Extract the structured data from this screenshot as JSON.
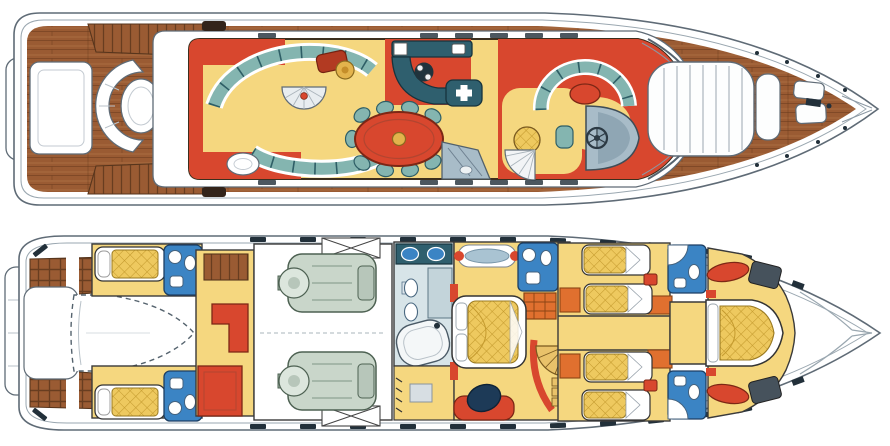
{
  "figure": {
    "label": "Motor yacht general arrangement drawing with two deck plans",
    "views": {
      "upper": {
        "label": "Main deck plan: aft cockpit with curved bench and table, saloon with curved sofas, dining table for nine, galley, raised pilothouse with helm and C-shaped settee, bow sunpad and anchor gear"
      },
      "lower": {
        "label": "Lower deck plan: swim platform, tender garage, crew quarters with bunks, engine room with twin engines, full-beam master cabin with en-suite, two twin guest cabins with bathrooms, forward VIP cabin"
      }
    }
  },
  "palette": {
    "wood": "#9a5b33",
    "wood_dark": "#6e3f1f",
    "floor_yellow": "#f5d77f",
    "mattress": "#eec95f",
    "quilt_line": "#c49a2e",
    "sofa": "#84b5b0",
    "sofa_dark": "#2e5e66",
    "counter": "#2f5f6e",
    "red": "#d8472e",
    "red_deep": "#b23a22",
    "orange": "#e0702f",
    "gold": "#e3b34c",
    "bath_blue": "#3b84c4",
    "engine": "#c9d6ca",
    "line": "#5f6b76",
    "inner_line": "#9aa7b0",
    "gray_furn": "#a8bcc8",
    "stair": "#e9c26a",
    "tile": "#d7e4e8",
    "tv": "#1d3a57",
    "dark": "#22303a",
    "paper": "#ffffff"
  },
  "decks": {
    "upper": {
      "label": "Main deck",
      "rooms": [
        "swim-platform",
        "aft-deck",
        "cockpit-bench",
        "saloon-lounge",
        "dining-area",
        "galley",
        "pilothouse",
        "bow-sunpad",
        "foredeck-anchor-gear"
      ]
    },
    "lower": {
      "label": "Lower deck",
      "rooms": [
        "swim-platform",
        "tender-garage",
        "crew-cabins",
        "crew-mess",
        "engine-room",
        "master-bathroom",
        "master-cabin",
        "guest-cabin-port",
        "guest-cabin-starboard",
        "guest-bathrooms",
        "vip-cabin",
        "bow-locker"
      ]
    }
  }
}
